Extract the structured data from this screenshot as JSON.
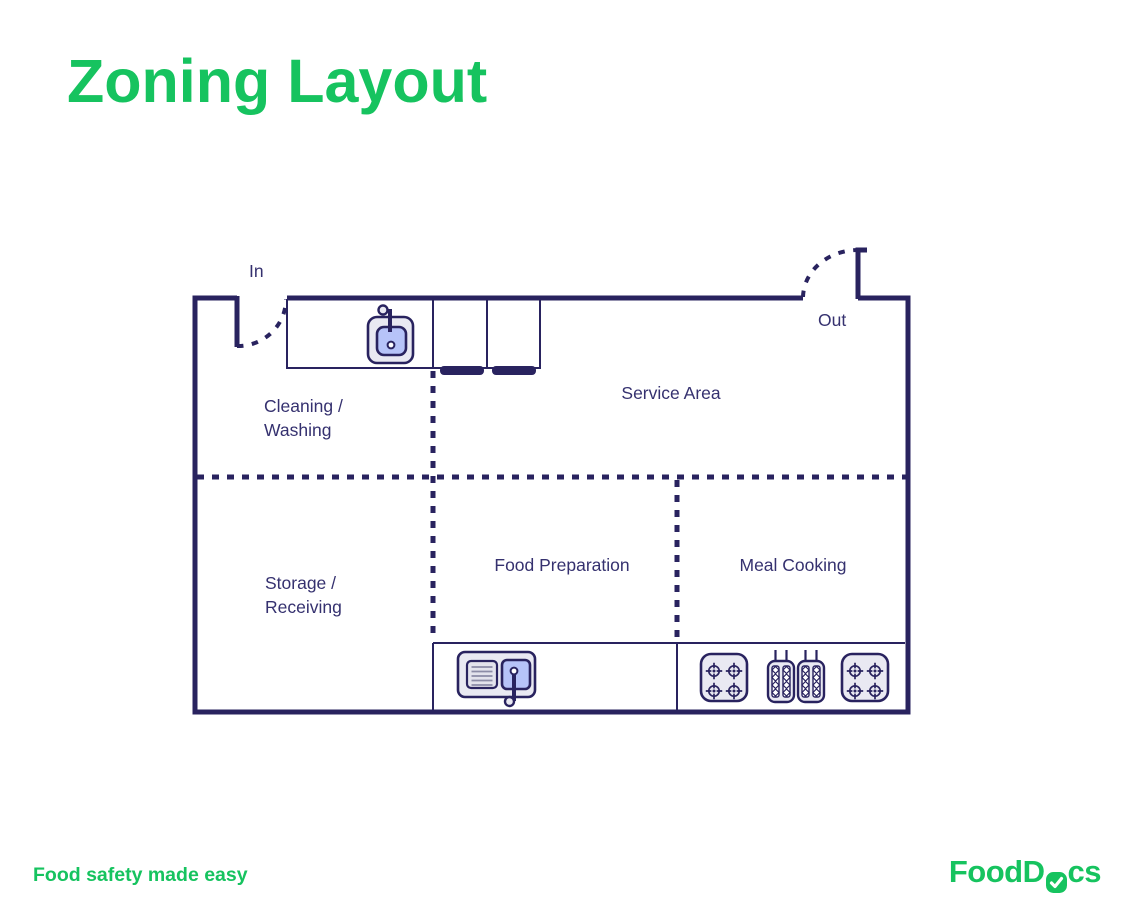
{
  "title": "Zoning Layout",
  "colors": {
    "accent_green": "#16c35f",
    "wall_navy": "#29235f",
    "label_navy": "#35316f",
    "periwinkle_fill": "#b6c3f8",
    "equipment_fill": "#e9e9f2"
  },
  "doors": {
    "in_label": "In",
    "out_label": "Out"
  },
  "zones": [
    {
      "id": "cleaning-washing",
      "label": "Cleaning /\nWashing"
    },
    {
      "id": "service-area",
      "label": "Service Area"
    },
    {
      "id": "storage-receiving",
      "label": "Storage /\nReceiving"
    },
    {
      "id": "food-preparation",
      "label": "Food Preparation"
    },
    {
      "id": "meal-cooking",
      "label": "Meal Cooking"
    }
  ],
  "equipment_icons": [
    "wash-sink-icon",
    "service-counter-hatch-icon",
    "prep-sink-dishwasher-icon",
    "stove-four-burner-icon",
    "double-grill-icon",
    "stove-four-burner-icon"
  ],
  "footer": {
    "tagline": "Food safety made easy"
  },
  "logo": {
    "part1": "FoodD",
    "part2": "cs",
    "full": "FoodDocs"
  }
}
